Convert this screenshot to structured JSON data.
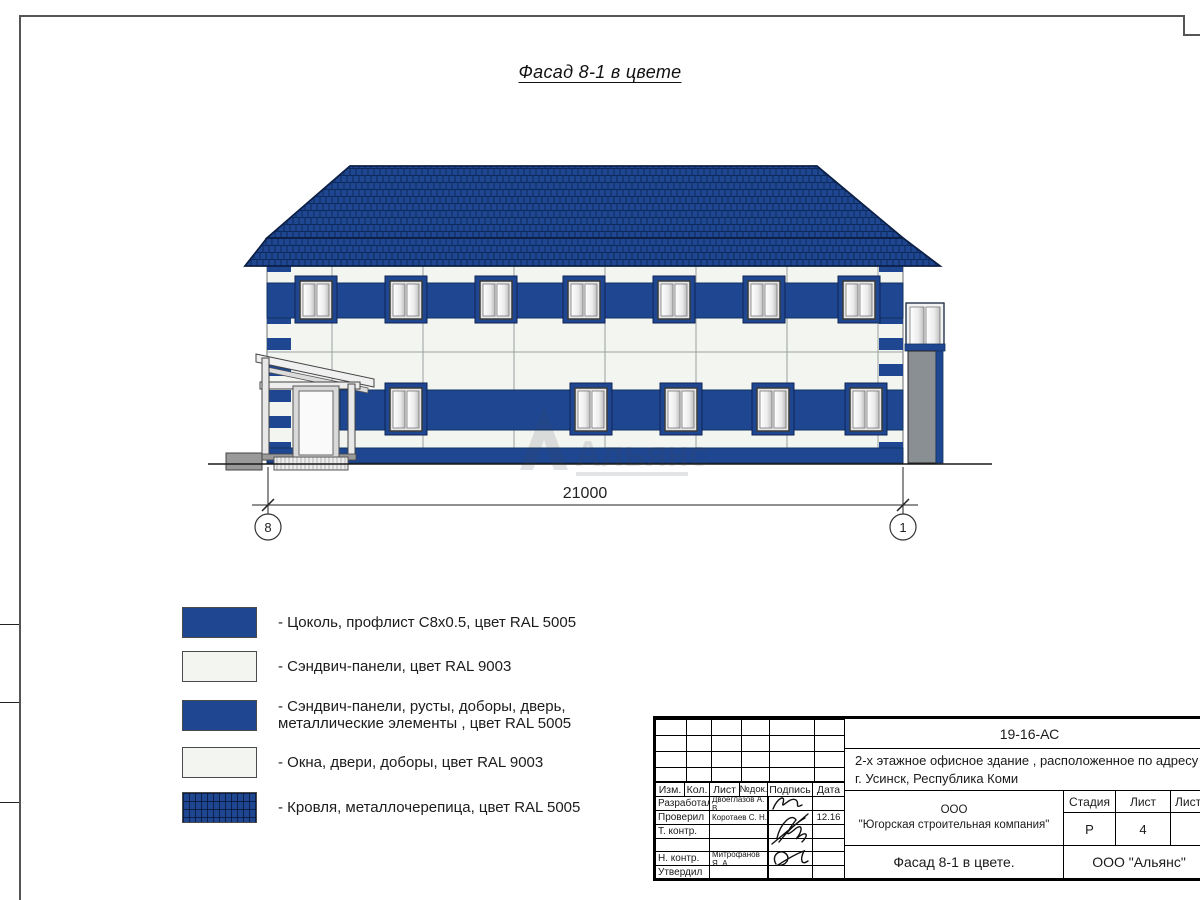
{
  "sheet": {
    "title": "Фасад 8-1 в цвете"
  },
  "drawing": {
    "dimension": "21000",
    "axis_left": "8",
    "axis_right": "1",
    "watermark": "Альянс"
  },
  "legend": {
    "items": [
      {
        "line1": "- Цоколь, профлист С8х0.5, цвет RAL 5005",
        "line2": ""
      },
      {
        "line1": "- Сэндвич-панели, цвет RAL 9003",
        "line2": ""
      },
      {
        "line1": "- Сэндвич-панели, русты, доборы, дверь,",
        "line2": "металлические элементы , цвет RAL 5005"
      },
      {
        "line1": "- Окна, двери, доборы, цвет RAL 9003",
        "line2": ""
      },
      {
        "line1": "- Кровля, металлочерепица, цвет RAL 5005",
        "line2": ""
      }
    ]
  },
  "title_block": {
    "doc_number": "19-16-АС",
    "description_line1": "2-х этажное офисное здание , расположенное по адресу",
    "description_line2": "г. Усинск, Республика Коми",
    "headers": {
      "izm": "Изм.",
      "kol": "Кол.",
      "list": "Лист",
      "ndoc": "№док.",
      "podpis": "Подпись",
      "data": "Дата"
    },
    "rows": [
      {
        "role": "Разработал",
        "name": "Двоеглазов А. В.",
        "date": ""
      },
      {
        "role": "Проверил",
        "name": "Коротаев С. Н.",
        "date": "12.16"
      },
      {
        "role": "Т. контр.",
        "name": "",
        "date": ""
      },
      {
        "role": "",
        "name": "",
        "date": ""
      },
      {
        "role": "Н. контр.",
        "name": "Митрофанов Я. А.",
        "date": ""
      },
      {
        "role": "Утвердил",
        "name": "",
        "date": ""
      }
    ],
    "company_line1": "ООО",
    "company_line2": "\"Югорская строительная компания\"",
    "stage_label": "Стадия",
    "stage_value": "Р",
    "sheet_label": "Лист",
    "sheet_value": "4",
    "sheets_label": "Листов",
    "sheets_value": "",
    "object_title": "Фасад 8-1 в цвете.",
    "org_name": "ООО \"Альянс\""
  },
  "colors": {
    "ral_5005_blue": "#1e4691",
    "ral_9003_white": "#f3f5f1",
    "roof_grid": "#0e2a5c",
    "gray_element": "#8a8f94"
  }
}
